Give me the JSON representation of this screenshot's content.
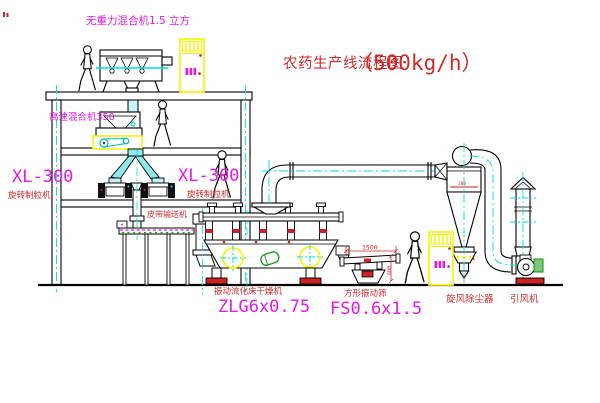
{
  "diagram": {
    "title": {
      "name": "农药生产线流程图",
      "capacity": "（500kg/h）"
    },
    "labels": {
      "gravity_mixer": "无重力混合机1.5 立方",
      "high_speed_mixer": "高速混合机350",
      "granulator_model_left": "XL-300",
      "granulator_name_left": "旋转制粒机",
      "granulator_model_right": "XL-300",
      "granulator_name_right": "旋转制粒机",
      "belt_conveyor": "皮带输送机",
      "dryer_name": "振动流化床干燥机",
      "dryer_model": "ZLG6x0.75",
      "screen_name": "方形振动筛",
      "screen_model": "FS0.6x1.5",
      "cyclone_name": "旋风除尘器",
      "fan_name": "引风机"
    },
    "dimensions": {
      "screen_length": "1500",
      "screen_width": "600",
      "cyclone_dia": "300"
    },
    "colors": {
      "background": "#ffffff",
      "line": "#000000",
      "centerline_cyan": "#00dede",
      "label_red": "#cf2b2b",
      "label_magenta": "#e818e8",
      "highlight_yellow": "#f5f500",
      "accent_green": "#1f9e1f",
      "base_red": "#cc2222"
    }
  }
}
